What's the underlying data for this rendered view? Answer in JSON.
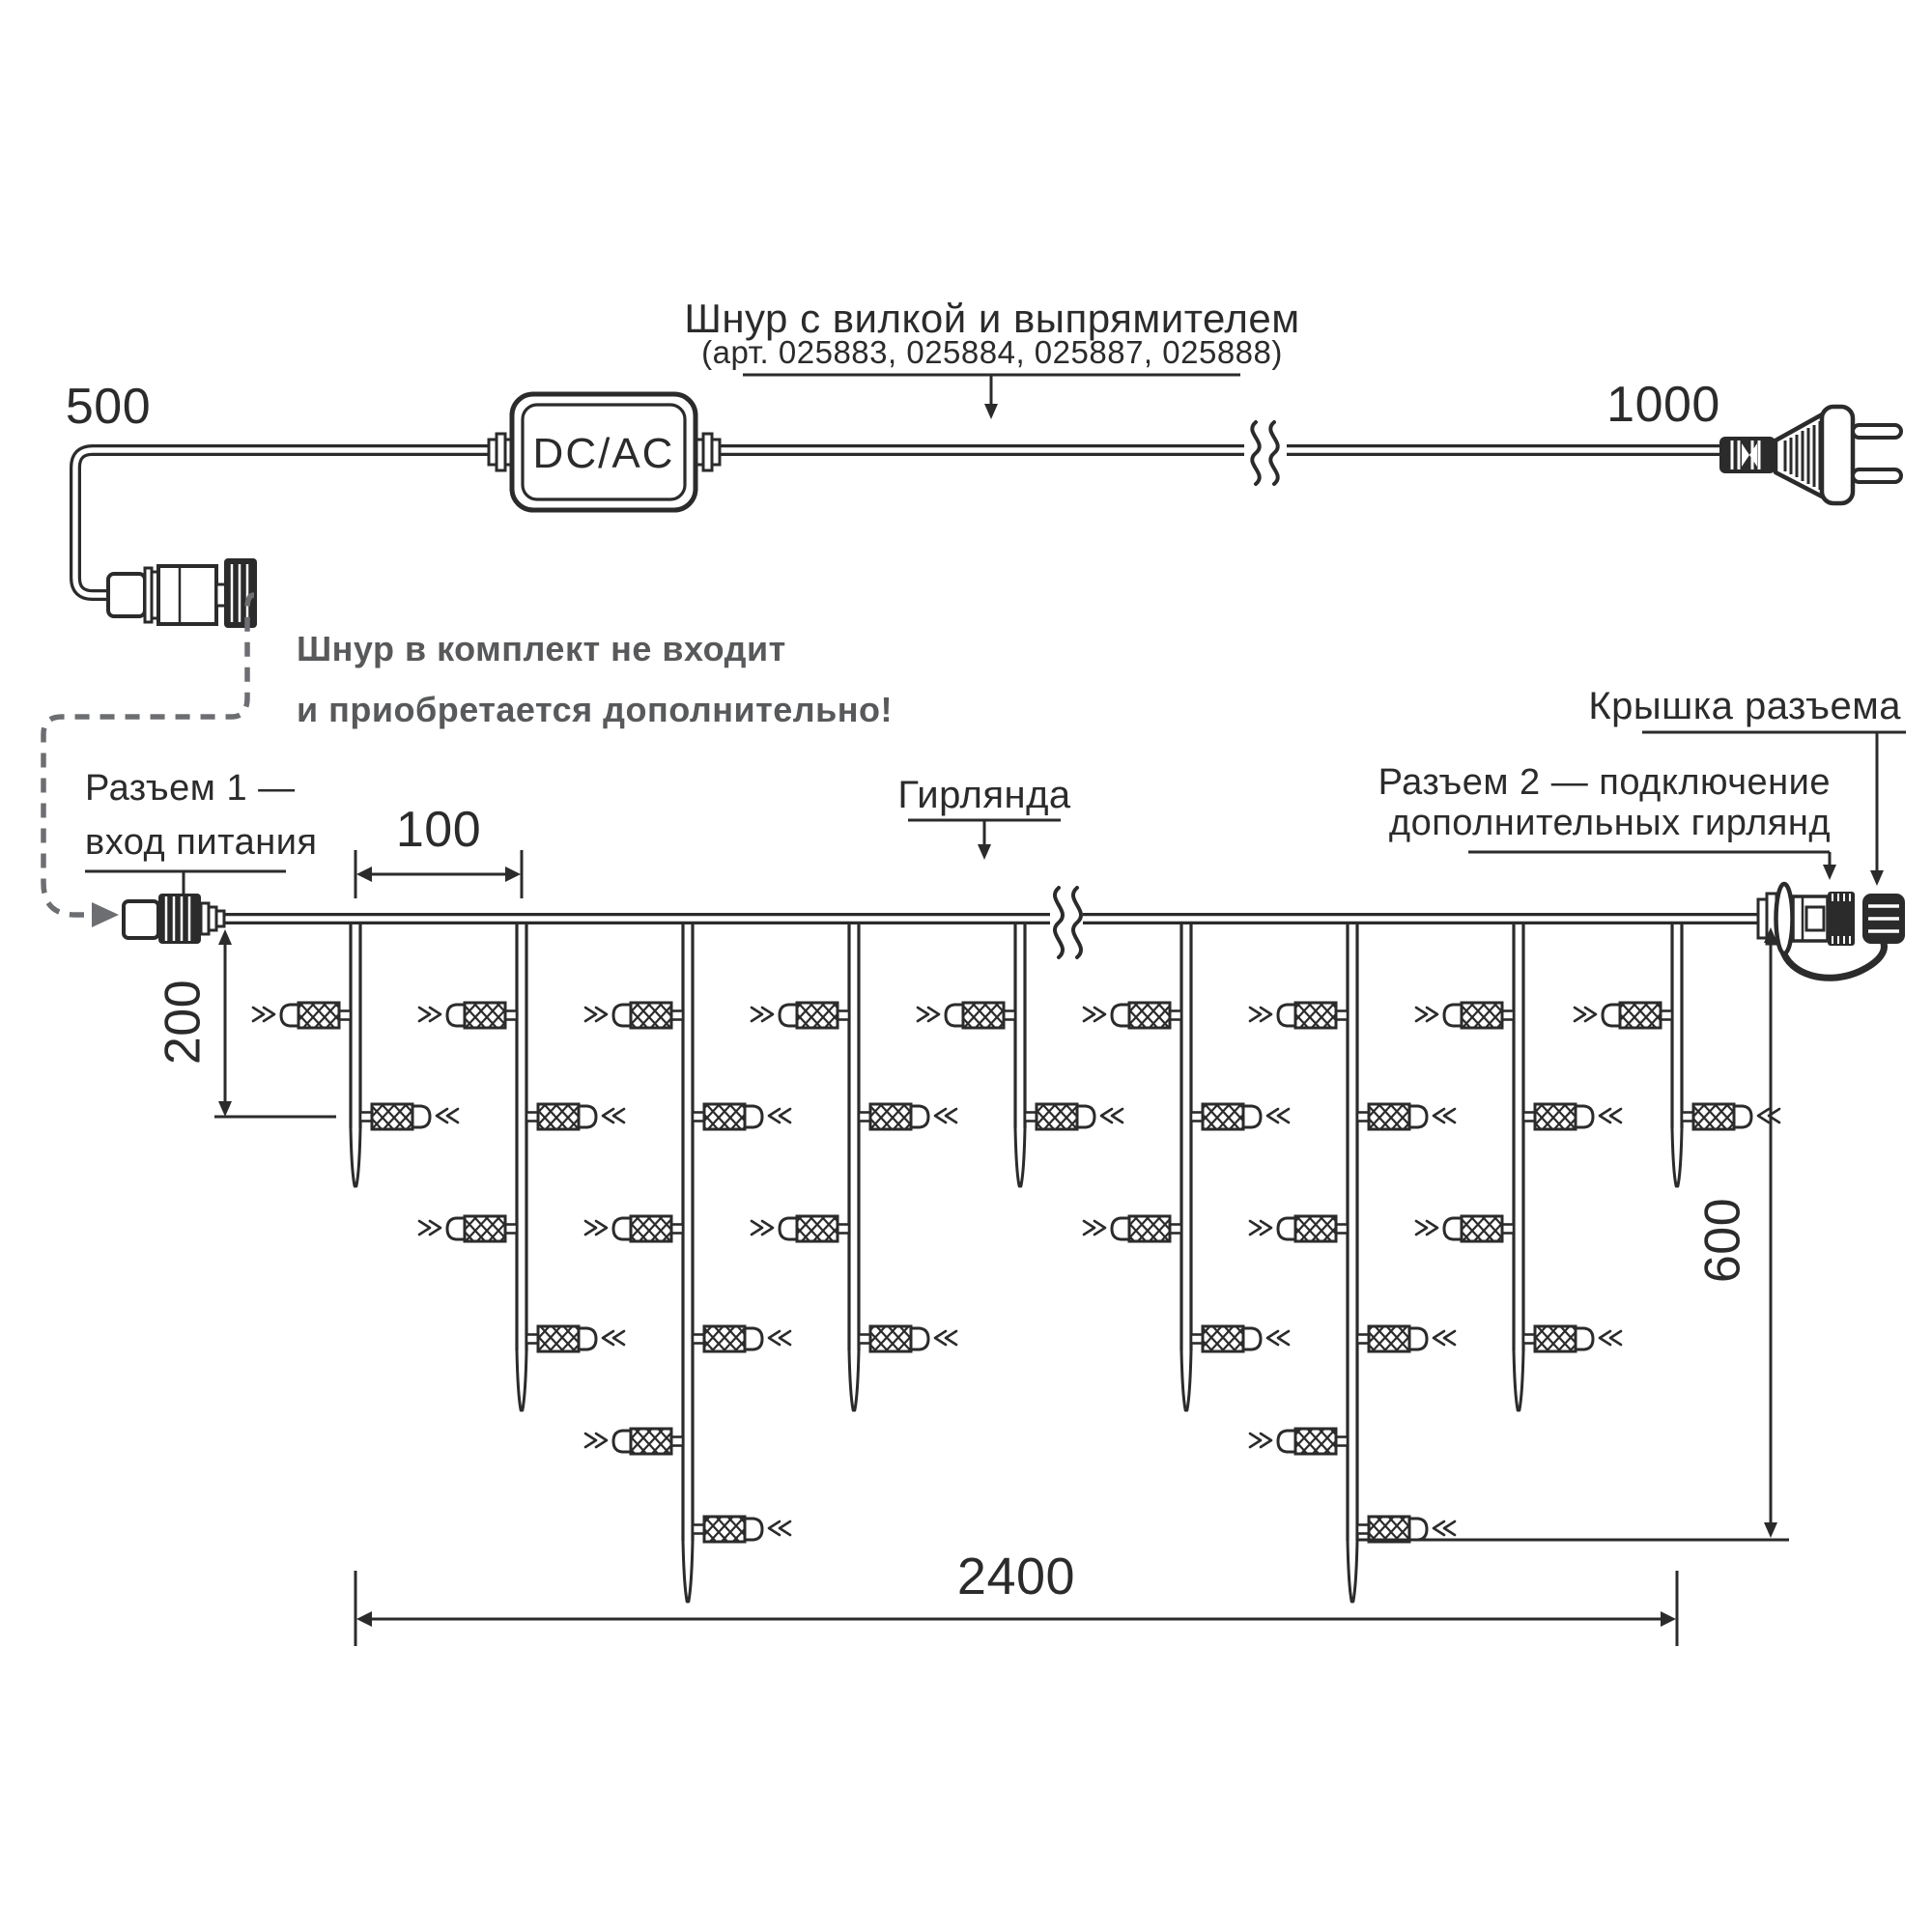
{
  "diagram": {
    "cord_section": {
      "label_line1": "Шнур с вилкой и выпрямителем",
      "label_line2": "(арт. 025883, 025884, 025887, 025888)",
      "dim_left": "500",
      "dim_right": "1000",
      "converter_label": "DC/AC",
      "note_line1": "Шнур в комплект не входит",
      "note_line2": "и приобретается дополнительно!"
    },
    "garland_section": {
      "connector1_line1": "Разъем 1 —",
      "connector1_line2": "вход питания",
      "garland_label": "Гирлянда",
      "connector2_line1": "Разъем 2 — подключение",
      "connector2_line2": "дополнительных гирлянд",
      "cap_label": "Крышка разъема",
      "dim_spacing": "100",
      "dim_first_drop": "200",
      "dim_height": "600",
      "dim_length": "2400"
    },
    "garland": {
      "drops": [
        {
          "lights": 2
        },
        {
          "lights": 4
        },
        {
          "lights": 6
        },
        {
          "lights": 4
        },
        {
          "lights": 2
        },
        {
          "lights": 4
        },
        {
          "lights": 6
        },
        {
          "lights": 4
        },
        {
          "lights": 2
        }
      ]
    },
    "colors": {
      "line": "#2b2b2b",
      "note_gray": "#58595b",
      "dashed_gray": "#6d6e71"
    }
  }
}
